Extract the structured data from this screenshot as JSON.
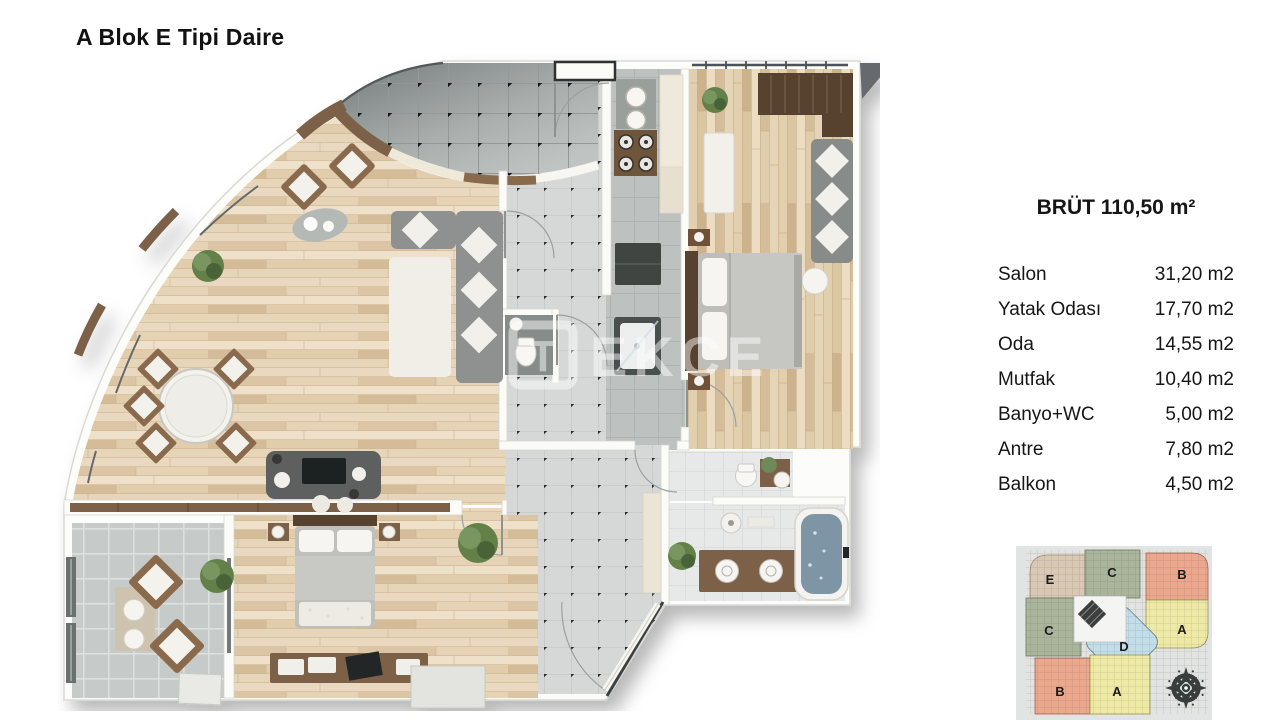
{
  "title": "A Blok E Tipi Daire",
  "summary": {
    "gross_area": "BRÜT 110,50 m²"
  },
  "rooms": [
    {
      "name": "Salon",
      "area": "31,20 m2"
    },
    {
      "name": "Yatak Odası",
      "area": "17,70 m2"
    },
    {
      "name": "Oda",
      "area": "14,55 m2"
    },
    {
      "name": "Mutfak",
      "area": "10,40 m2"
    },
    {
      "name": "Banyo+WC",
      "area": "5,00 m2"
    },
    {
      "name": "Antre",
      "area": "7,80 m2"
    },
    {
      "name": "Balkon",
      "area": "4,50 m2"
    }
  ],
  "watermark": {
    "logo_letter": "T",
    "text": "EKCE"
  },
  "keyplan": {
    "blocks": [
      {
        "label": "E",
        "color": "#d9c8b3"
      },
      {
        "label": "C",
        "color": "#aab59c"
      },
      {
        "label": "B",
        "color": "#eba88f"
      },
      {
        "label": "C",
        "color": "#aab59c"
      },
      {
        "label": "A",
        "color": "#eeeaa6"
      },
      {
        "label": "D",
        "color": "#c3dde9"
      },
      {
        "label": "B",
        "color": "#eba88f"
      },
      {
        "label": "A",
        "color": "#eeeaa6"
      }
    ]
  },
  "palette": {
    "wood_floor": "#e4d2b5",
    "dark_wood": "#57432f",
    "tile_gray": "#d6d8d7",
    "terrace_dark": "#747c7c",
    "water": "#7e95a5",
    "wall": "#fbfbf8",
    "keyplan_bg": "#e2e4e3"
  }
}
